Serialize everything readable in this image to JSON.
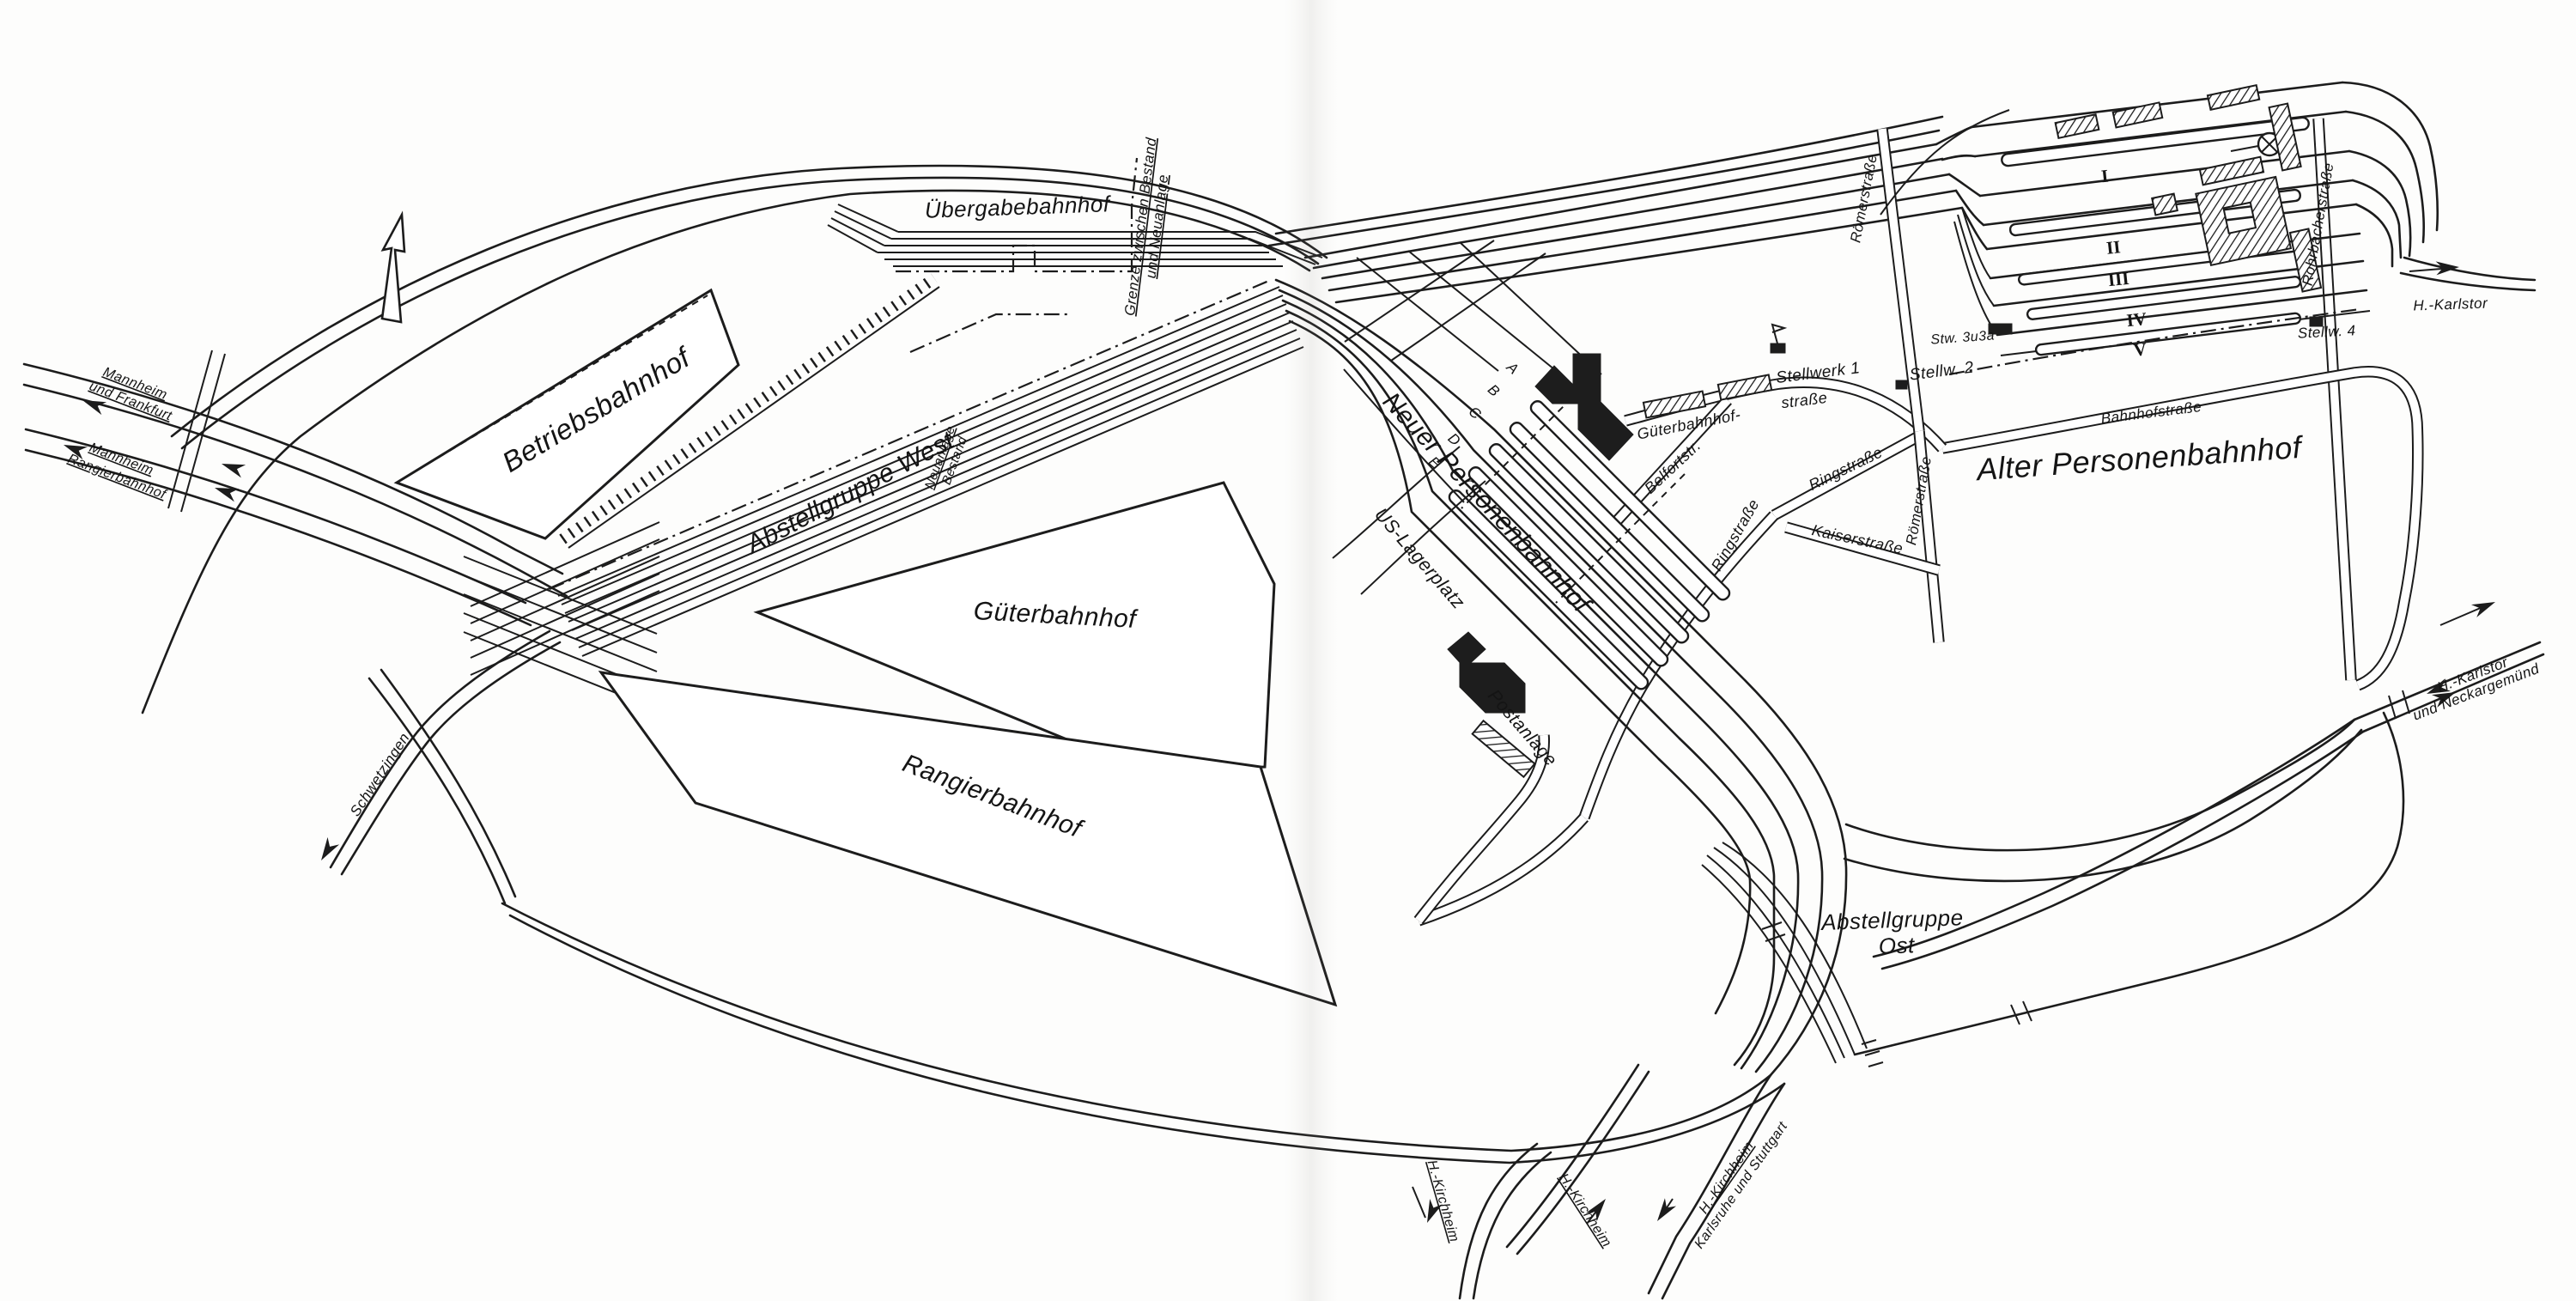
{
  "yards": {
    "betriebsbahnhof": "Betriebsbahnhof",
    "abstellgruppe_west": "Abstellgruppe West",
    "uebergabebahnhof": "Übergabebahnhof",
    "gueterbahnhof": "Güterbahnhof",
    "rangierbahnhof": "Rangierbahnhof",
    "neuer_personenbahnhof": "Neuer Personenbahnhof",
    "alter_personenbahnhof": "Alter Personenbahnhof",
    "abstellgruppe_ost": [
      "Abstellgruppe",
      "Ost"
    ],
    "us_lagerplatz": "US-Lagerplatz",
    "postanlage": "Postanlage"
  },
  "boundary": {
    "grenze": [
      "Grenze zwischen Bestand",
      "und Neuanlage"
    ],
    "neuanlage_bestand": [
      "Neuanlage",
      "Bestand"
    ]
  },
  "destinations": {
    "mannheim_frankfurt": [
      "Mannheim",
      "und Frankfurt"
    ],
    "mannheim_rangierbahnhof": [
      "Mannheim",
      "Rangierbahnhof"
    ],
    "schwetzingen": "Schwetzingen",
    "kirchheim_west": "H.-Kirchheim",
    "kirchheim_mid": "H.-Kirchheim",
    "kirchheim_karlsruhe": [
      "H.-Kirchheim",
      "Karlsruhe und Stuttgart"
    ],
    "karlstor": "H.-Karlstor",
    "karlstor_neckargemuend": [
      "H.-Karlstor",
      "und Neckargemünd"
    ]
  },
  "streets": {
    "gueterbahnhofstrasse": [
      "Güterbahnhof-",
      "straße"
    ],
    "belfortstrasse": "Belfortstr.",
    "ringstrasse_ne": "Ringstraße",
    "ringstrasse_sw": "Ringstraße",
    "kaiserstrasse": "Kaiserstraße",
    "roemerstrasse_nord": "Römerstraße",
    "roemerstrasse_sued": "Römerstraße",
    "rohrbacherstrasse": "Rohrbacherstraße",
    "bahnhofstrasse": "Bahnhofstraße"
  },
  "signal_boxes": {
    "stellwerk1": "Stellwerk 1",
    "stellw2": "Stellw. 2",
    "stw3u3a": "Stw. 3u3a",
    "stellw4": "Stellw. 4"
  },
  "platform_letters": [
    "A",
    "B",
    "C",
    "D",
    "E"
  ],
  "track_numerals": [
    "I",
    "II",
    "III",
    "IV",
    "V"
  ],
  "colors": {
    "ink": "#1c1c1c",
    "paper": "#fdfdfc"
  }
}
